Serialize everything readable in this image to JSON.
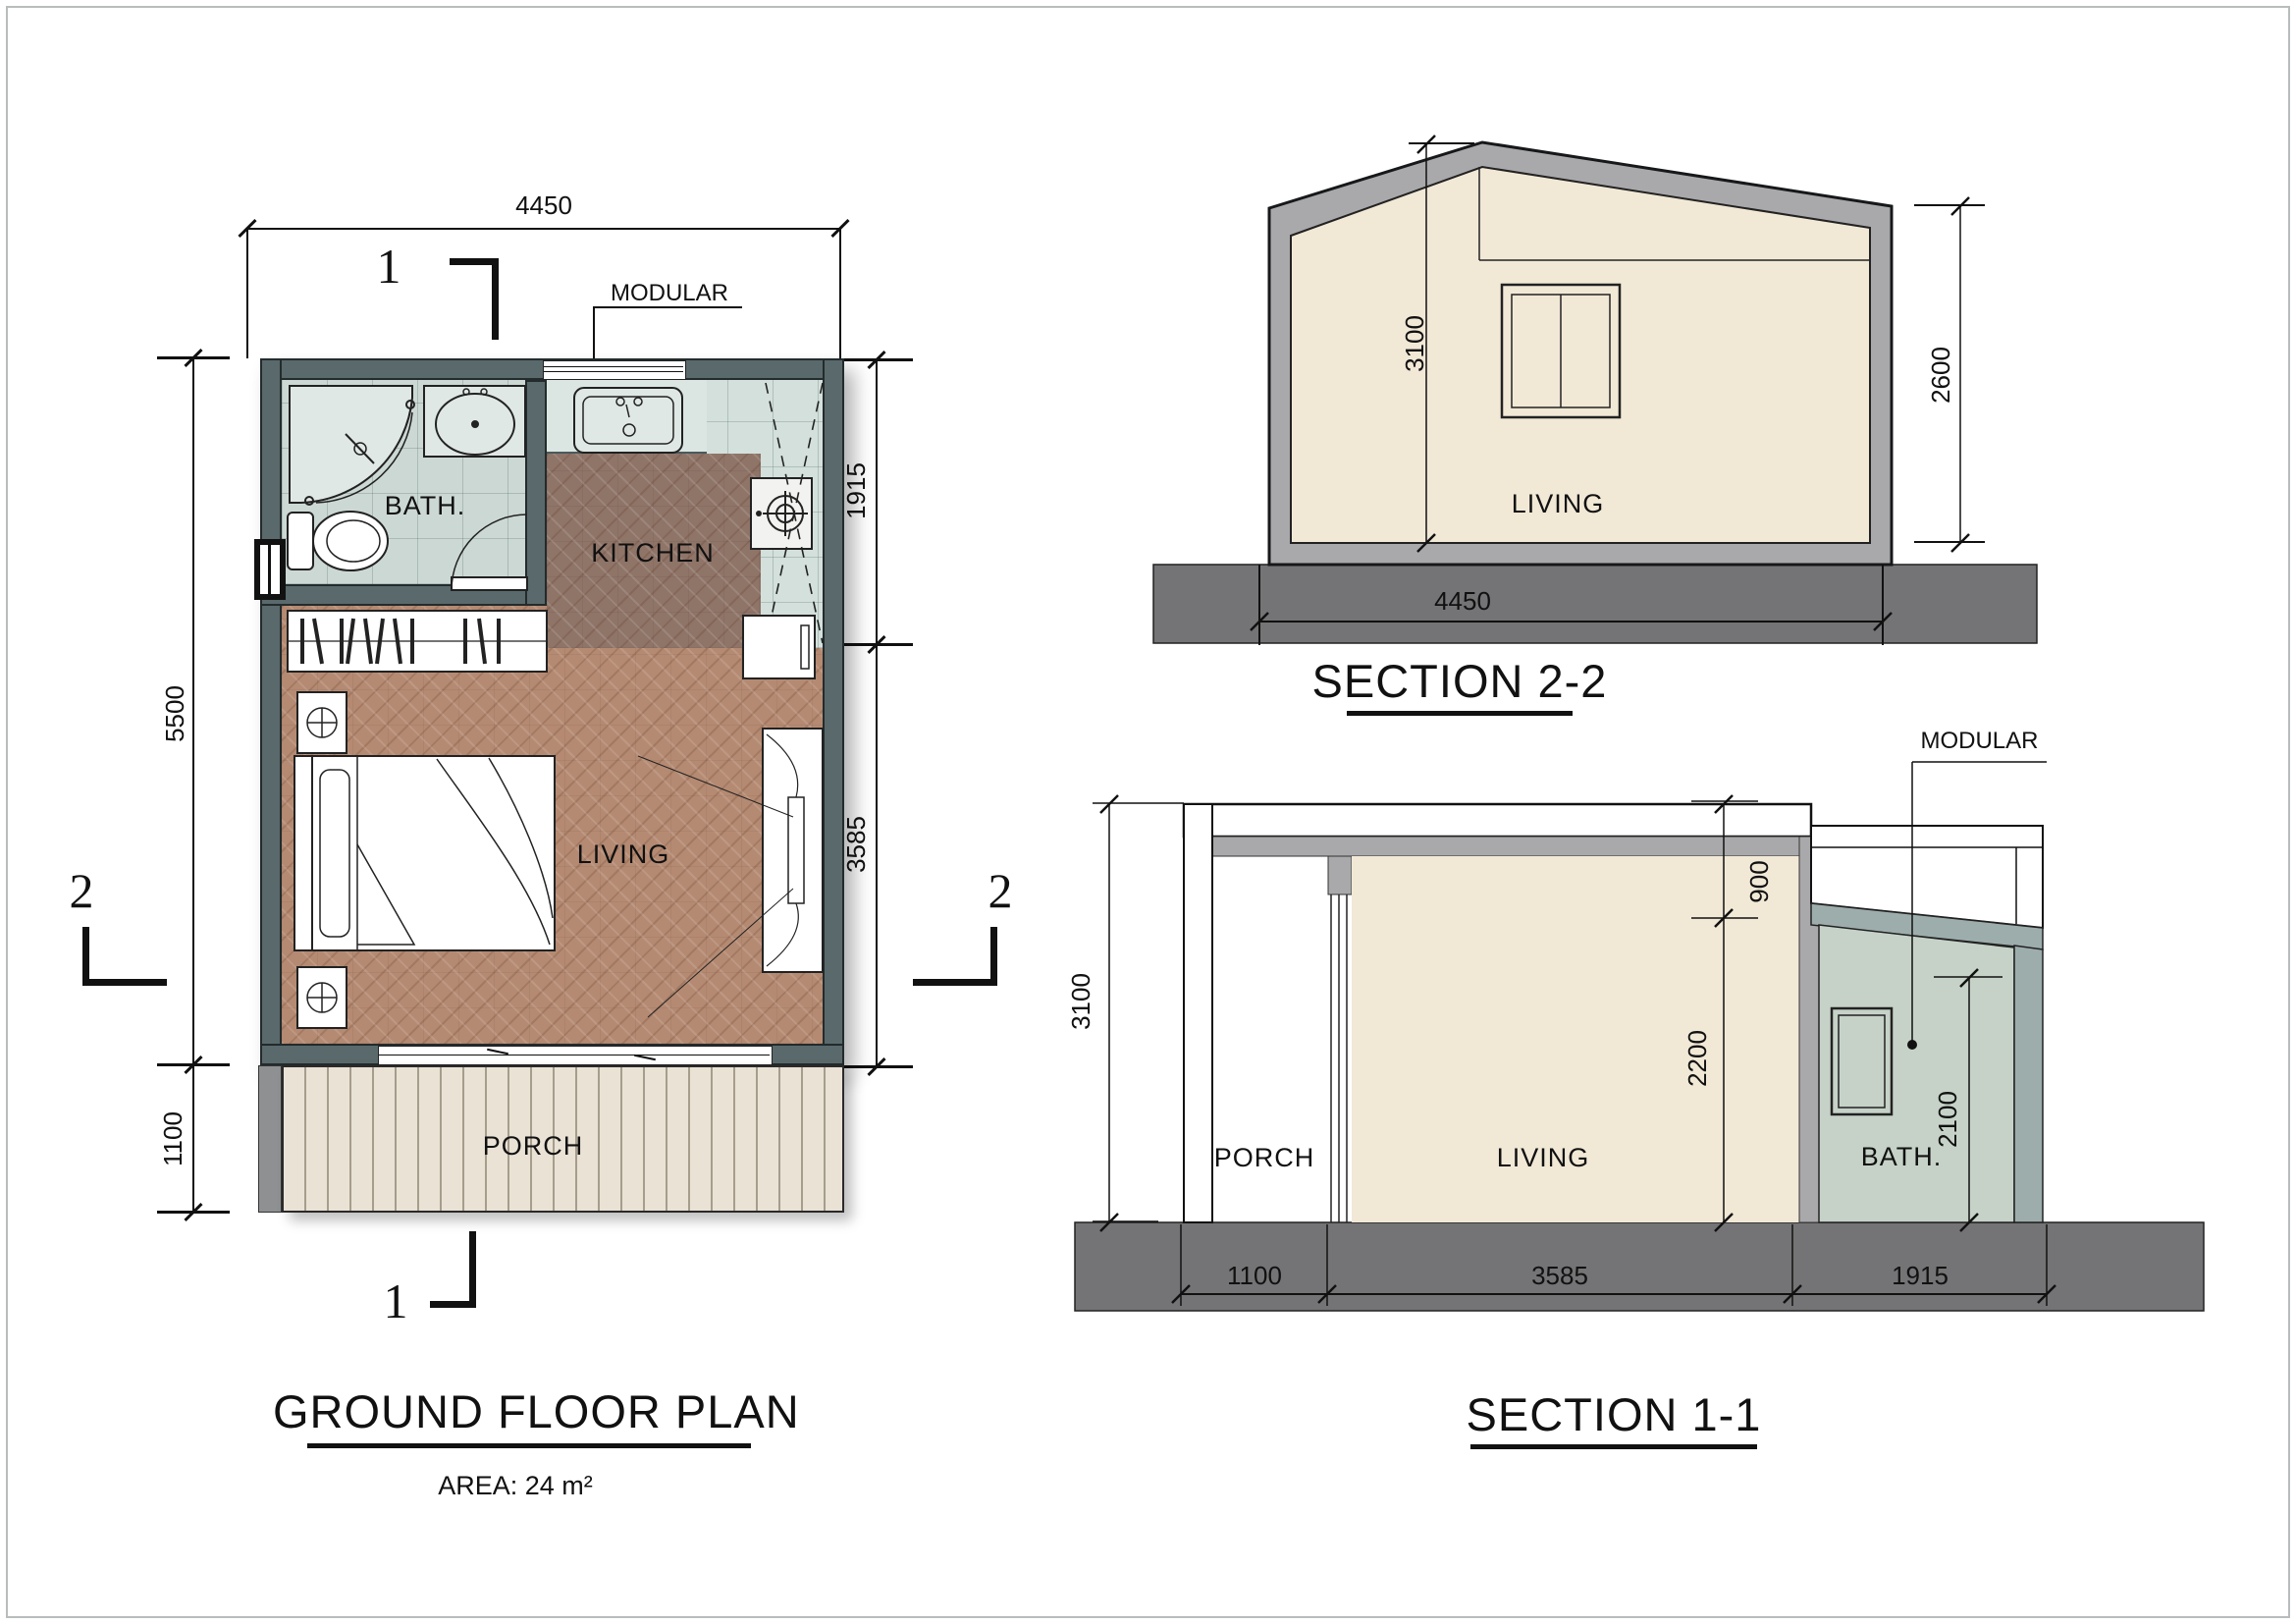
{
  "plan": {
    "title": "GROUND FLOOR PLAN",
    "area_label": "AREA: 24 m²",
    "module_label": "MODULAR",
    "rooms": {
      "bath": "BATH.",
      "kitchen": "KITCHEN",
      "living": "LIVING",
      "porch": "PORCH"
    },
    "dims": {
      "top_width": "4450",
      "left_height": "5500",
      "left_porch": "1100",
      "right_module": "1915",
      "right_living": "3585"
    },
    "section_markers": {
      "vertical": "1",
      "horizontal": "2"
    }
  },
  "section22": {
    "title": "SECTION 2-2",
    "room": "LIVING",
    "dims": {
      "ridge": "3100",
      "eave": "2600",
      "width": "4450"
    }
  },
  "section11": {
    "title": "SECTION 1-1",
    "module_label": "MODULAR",
    "rooms": {
      "porch": "PORCH",
      "living": "LIVING",
      "bath": "BATH."
    },
    "dims": {
      "total": "3100",
      "roof": "900",
      "living": "2200",
      "bath": "2100",
      "porch_w": "1100",
      "living_w": "3585",
      "bath_w": "1915"
    }
  }
}
